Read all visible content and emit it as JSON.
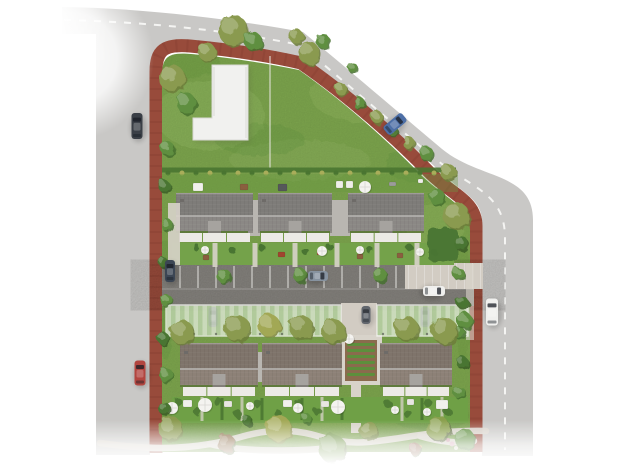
{
  "scene": {
    "description": "aerial-site-plan-render",
    "canvas": {
      "width": 640,
      "height": 470,
      "background": "#ffffff"
    },
    "palette": {
      "road": "#c9c8c6",
      "dash": "#f4f4f2",
      "curb": "#984b3b",
      "lawn": "#7ea74e",
      "lawnLight": "#93b861",
      "lawnDark": "#689840",
      "hedge": "#4a7531",
      "bushYellow": "#a9ad5a",
      "treeOlive": "#8a9a4f",
      "treeGreen": "#5f8f3f",
      "treeYellow": "#a2a855",
      "treeDark": "#3f652",
      "roofTop": "#8b8885",
      "roofTopDark": "#7e7c79",
      "ridge": "#b8b6b3",
      "roofBottom": "#8d8177",
      "roofBottomDark": "#7f746b",
      "connector": "#b9b6b1",
      "facade": "#eceae6",
      "notch": "#a6a39f",
      "path": "#d8d3ca",
      "apron": "#d2ccc3",
      "asphalt": "#87847f",
      "asphaltDark": "#7b7873",
      "parkingLine": "#e0dedb",
      "carport": "#e3ecdb",
      "carportStripe": "#c2d8b3",
      "carportFrame": "#f2f4ee",
      "soil": "#8a6b4d",
      "bed": "#5d8f3c",
      "terrace": "#f0efec",
      "chimney": "#6e6b68"
    },
    "roads": {
      "surface": "M 62,7 C 140,8 225,18 303,32 C 355,75 405,118 442,149 C 480,180 533,172 533,220 L 533,456 L 482,456 L 482,222 C 482,198 462,194 433,165 C 398,132 348,90 297,57 C 255,49 220,44 190,41 C 164,39 150,47 150,70 L 150,455 L 96,455 L 96,34 L 62,34 Z",
      "curb": "M 156,453 L 156,72 C 156,50 164,44 190,46 C 222,49 262,54 301,63 C 349,96 397,139 427,170 C 451,195 476,200 476,226 L 476,452",
      "centerDash": "M 64,20 C 150,22 232,31 300,45 C 350,86 400,130 437,160 C 470,188 505,192 505,238 L 505,450",
      "site": "M 162,452 L 162,76 C 162,57 168,52 191,54 C 224,57 260,62 299,70 C 345,102 390,143 420,174 C 444,198 470,206 470,230 L 470,452 Z"
    },
    "lawnPatches": [
      {
        "x": 210,
        "y": 115,
        "rx": 55,
        "ry": 35,
        "c": "lawnLight",
        "o": 0.45
      },
      {
        "x": 370,
        "y": 95,
        "rx": 60,
        "ry": 28,
        "c": "lawnLight",
        "o": 0.4
      },
      {
        "x": 300,
        "y": 160,
        "rx": 70,
        "ry": 20,
        "c": "lawnLight",
        "o": 0.35
      },
      {
        "x": 435,
        "y": 225,
        "rx": 30,
        "ry": 22,
        "c": "lawnLight",
        "o": 0.4
      },
      {
        "x": 190,
        "y": 60,
        "rx": 30,
        "ry": 18,
        "c": "lawnDark",
        "o": 0.35
      },
      {
        "x": 260,
        "y": 140,
        "rx": 45,
        "ry": 16,
        "c": "lawnDark",
        "o": 0.3
      },
      {
        "x": 420,
        "y": 165,
        "rx": 35,
        "ry": 18,
        "c": "lawnDark",
        "o": 0.3
      },
      {
        "x": 200,
        "y": 425,
        "rx": 55,
        "ry": 20,
        "c": "lawnDark",
        "o": 0.35
      },
      {
        "x": 300,
        "y": 430,
        "rx": 60,
        "ry": 18,
        "c": "lawnLight",
        "o": 0.4
      },
      {
        "x": 430,
        "y": 415,
        "rx": 40,
        "ry": 16,
        "c": "lawnDark",
        "o": 0.3
      },
      {
        "x": 166,
        "y": 300,
        "rx": 10,
        "ry": 60,
        "c": "lawnDark",
        "o": 0.3
      },
      {
        "x": 463,
        "y": 300,
        "rx": 9,
        "ry": 60,
        "c": "lawnDark",
        "o": 0.25
      }
    ],
    "lBuilding": {
      "outline": "M 212,65 L 248,65 L 248,140 L 193,140 L 193,118 L 212,118 Z",
      "fill": "#f1f1ef",
      "edge": "#d9d9d6",
      "fenceX": 270,
      "fenceTop": 56,
      "fenceBottom": 168
    },
    "boundaryHedge": {
      "y": 170,
      "x1": 162,
      "x2": 456,
      "dotStep": 14
    },
    "sharedGarden": {
      "x": 162,
      "y": 174,
      "w": 296,
      "h": 18
    },
    "furniture": [
      {
        "x": 193,
        "y": 183,
        "w": 10,
        "h": 8,
        "c": "#f1f0ec"
      },
      {
        "x": 240,
        "y": 184,
        "w": 8,
        "h": 6,
        "c": "#8a5f3f"
      },
      {
        "x": 278,
        "y": 184,
        "w": 9,
        "h": 7,
        "c": "#55585a"
      },
      {
        "x": 336,
        "y": 181,
        "w": 7,
        "h": 7,
        "c": "#efeeea"
      },
      {
        "x": 346,
        "y": 181,
        "w": 7,
        "h": 7,
        "c": "#efeeea"
      },
      {
        "x": 389,
        "y": 182,
        "w": 7,
        "h": 4,
        "c": "#9b9c9a"
      },
      {
        "x": 418,
        "y": 179,
        "w": 5,
        "h": 4,
        "c": "#efeeea"
      },
      {
        "x": 278,
        "y": 252,
        "w": 7,
        "h": 5,
        "c": "#a0452f"
      },
      {
        "x": 203,
        "y": 255,
        "w": 6,
        "h": 5,
        "c": "#8a5f3f"
      },
      {
        "x": 317,
        "y": 250,
        "w": 6,
        "h": 5,
        "c": "#a0452f"
      },
      {
        "x": 357,
        "y": 254,
        "w": 6,
        "h": 5,
        "c": "#8a5f3f"
      },
      {
        "x": 397,
        "y": 253,
        "w": 6,
        "h": 5,
        "c": "#8a5f3f"
      },
      {
        "x": 436,
        "y": 400,
        "w": 12,
        "h": 9,
        "c": "#f1f0ec"
      },
      {
        "x": 183,
        "y": 400,
        "w": 9,
        "h": 7,
        "c": "#f1f0ec"
      },
      {
        "x": 283,
        "y": 400,
        "w": 9,
        "h": 7,
        "c": "#f1f0ec"
      },
      {
        "x": 224,
        "y": 401,
        "w": 8,
        "h": 6,
        "c": "#e8e6e2"
      },
      {
        "x": 321,
        "y": 401,
        "w": 8,
        "h": 6,
        "c": "#e8e6e2"
      },
      {
        "x": 407,
        "y": 399,
        "w": 7,
        "h": 6,
        "c": "#e8e6e2"
      }
    ],
    "parking": {
      "asphalt": {
        "x": 162,
        "y": 264,
        "w": 312,
        "h": 42
      },
      "bayLines": {
        "from": 180,
        "to": 396,
        "step": 18,
        "y1": 266,
        "y2": 288
      },
      "apron": {
        "x": 405,
        "y": 263,
        "w": 78,
        "h": 26
      },
      "sidewalk": {
        "x": 466,
        "y": 264,
        "w": 8,
        "h": 76
      }
    },
    "carports": {
      "y": 305,
      "h": 31,
      "segments": [
        {
          "x": 166,
          "w": 175
        },
        {
          "x": 377,
          "w": 91
        }
      ],
      "corridor": {
        "x": 341,
        "y": 303,
        "w": 36,
        "h": 34
      }
    },
    "communityGarden": {
      "frame": {
        "x": 340,
        "y": 335,
        "w": 42,
        "h": 50
      },
      "soil": {
        "x": 345,
        "y": 340,
        "w": 32,
        "h": 41
      },
      "rows": {
        "x": 347,
        "w": 28,
        "y0": 343,
        "step": 6,
        "h": 3,
        "count": 6
      },
      "southPath": {
        "x": 351,
        "y": 385,
        "w": 10,
        "h": 48
      }
    },
    "houses": [
      {
        "row": "top",
        "x": 176,
        "w": 77
      },
      {
        "row": "top",
        "x": 258,
        "w": 74
      },
      {
        "row": "top",
        "x": 348,
        "w": 76
      },
      {
        "row": "bottom",
        "x": 180,
        "w": 78
      },
      {
        "row": "bottom",
        "x": 262,
        "w": 80
      },
      {
        "row": "bottom",
        "x": 380,
        "w": 72
      }
    ],
    "rowSpec": {
      "top": {
        "y": 193,
        "h": 48,
        "ridge": 216,
        "awningY": 233,
        "gardenY": 243,
        "gardenH": 22,
        "roof": "roofTop",
        "roofDark": "roofTopDark"
      },
      "bottom": {
        "y": 343,
        "h": 54,
        "ridge": 369,
        "awningY": 387,
        "gardenY": 397,
        "gardenH": 25,
        "roof": "roofBottom",
        "roofDark": "roofBottomDark"
      }
    },
    "connectors": [
      {
        "x": 248,
        "y": 200,
        "w": 12,
        "h": 36
      },
      {
        "x": 330,
        "y": 200,
        "w": 20,
        "h": 36
      },
      {
        "x": 254,
        "y": 352,
        "w": 10,
        "h": 30
      }
    ],
    "gardens": {
      "topStrip": {
        "x": 172,
        "y": 243,
        "w": 282,
        "h": 22,
        "c": "#74a24a"
      },
      "bottomStrips": [
        {
          "x": 172,
          "y": 397,
          "w": 296,
          "h": 26,
          "c": "#6fa046"
        },
        {
          "x": 380,
          "y": 397,
          "w": 86,
          "h": 26,
          "c": "#6fa046"
        }
      ],
      "topPaths": [
        215,
        255,
        295,
        337,
        377,
        417
      ],
      "westDrive": {
        "x": 168,
        "y": 203,
        "w": 12,
        "h": 62
      },
      "bottomDividersPath": [
        202,
        242,
        322,
        402,
        442
      ],
      "bottomDividersHedge": [
        222,
        262,
        302,
        342,
        422
      ]
    },
    "hedgeClumpsTop": [
      [
        196,
        247
      ],
      [
        232,
        250
      ],
      [
        262,
        248
      ],
      [
        306,
        252
      ],
      [
        330,
        247
      ],
      [
        370,
        250
      ],
      [
        410,
        248
      ],
      [
        434,
        252
      ]
    ],
    "hedgeClumpsBottom": [
      [
        178,
        402
      ],
      [
        198,
        412
      ],
      [
        218,
        402
      ],
      [
        238,
        414
      ],
      [
        258,
        404
      ],
      [
        278,
        414
      ],
      [
        298,
        403
      ],
      [
        318,
        412
      ],
      [
        388,
        404
      ],
      [
        408,
        414
      ],
      [
        428,
        403
      ],
      [
        448,
        412
      ]
    ],
    "hedgeBlock": {
      "x": 428,
      "y": 228,
      "w": 30,
      "h": 34
    },
    "flowers": [
      [
        452,
        444,
        2.5,
        "#d8a8b8"
      ],
      [
        456,
        448,
        2,
        "#e8e2d8"
      ],
      [
        448,
        440,
        2,
        "#c890a0"
      ],
      [
        420,
        447,
        2,
        "#caa24e"
      ]
    ],
    "windingPaths": [
      "M 100,443 C 150,450 180,449 210,444 C 245,438 252,430 288,431 C 318,432 330,445 368,442 C 405,439 430,430 486,431",
      "M 210,444 C 240,452 300,452 340,447",
      "M 420,436 C 440,442 460,444 474,441"
    ],
    "parasols": [
      [
        205,
        250,
        4
      ],
      [
        322,
        251,
        5
      ],
      [
        360,
        250,
        4
      ],
      [
        420,
        252,
        4
      ],
      [
        365,
        187,
        6
      ],
      [
        172,
        408,
        6
      ],
      [
        205,
        405,
        7
      ],
      [
        250,
        406,
        4
      ],
      [
        298,
        408,
        5
      ],
      [
        338,
        407,
        7
      ],
      [
        395,
        410,
        4
      ],
      [
        427,
        412,
        4
      ],
      [
        349,
        339,
        5
      ]
    ],
    "trees": [
      [
        172,
        78,
        13,
        "treeOlive"
      ],
      [
        186,
        103,
        10,
        "treeGreen"
      ],
      [
        207,
        52,
        9,
        "treeOlive"
      ],
      [
        233,
        30,
        15,
        "treeOlive"
      ],
      [
        253,
        41,
        9,
        "treeGreen"
      ],
      [
        296,
        36,
        7,
        "treeOlive"
      ],
      [
        309,
        53,
        11,
        "treeOlive"
      ],
      [
        323,
        41,
        7,
        "treeGreen"
      ],
      [
        352,
        67,
        5,
        "treeGreen"
      ],
      [
        341,
        89,
        6,
        "treeOlive"
      ],
      [
        359,
        103,
        6,
        "treeGreen"
      ],
      [
        377,
        117,
        6,
        "treeOlive"
      ],
      [
        393,
        131,
        5,
        "treeGreen"
      ],
      [
        409,
        143,
        6,
        "treeOlive"
      ],
      [
        426,
        153,
        7,
        "treeGreen"
      ],
      [
        448,
        172,
        8,
        "treeOlive"
      ],
      [
        456,
        215,
        13,
        "treeOlive"
      ],
      [
        437,
        197,
        8,
        "treeGreen"
      ],
      [
        167,
        148,
        7,
        "treeGreen"
      ],
      [
        164,
        186,
        6,
        "hedge"
      ],
      [
        167,
        225,
        6,
        "treeGreen"
      ],
      [
        163,
        262,
        5,
        "hedge"
      ],
      [
        166,
        300,
        6,
        "treeGreen"
      ],
      [
        163,
        338,
        6,
        "hedge"
      ],
      [
        166,
        375,
        7,
        "treeGreen"
      ],
      [
        164,
        408,
        6,
        "hedge"
      ],
      [
        461,
        243,
        7,
        "hedge"
      ],
      [
        458,
        273,
        6,
        "treeGreen"
      ],
      [
        462,
        302,
        6,
        "hedge"
      ],
      [
        459,
        332,
        6,
        "treeGreen"
      ],
      [
        462,
        362,
        6,
        "hedge"
      ],
      [
        459,
        392,
        6,
        "treeGreen"
      ],
      [
        182,
        332,
        12,
        "treeOlive"
      ],
      [
        237,
        328,
        13,
        "treeOlive"
      ],
      [
        269,
        325,
        11,
        "treeYellow"
      ],
      [
        301,
        327,
        12,
        "treeOlive"
      ],
      [
        333,
        331,
        12,
        "treeOlive"
      ],
      [
        406,
        328,
        12,
        "treeOlive"
      ],
      [
        444,
        330,
        13,
        "treeOlive"
      ],
      [
        464,
        320,
        8,
        "treeGreen"
      ],
      [
        224,
        276,
        7,
        "treeGreen"
      ],
      [
        300,
        275,
        7,
        "treeGreen"
      ],
      [
        380,
        275,
        7,
        "treeGreen"
      ],
      [
        170,
        428,
        12,
        "treeOlive"
      ],
      [
        226,
        443,
        9,
        "#8a6b45"
      ],
      [
        278,
        428,
        13,
        "treeYellow"
      ],
      [
        332,
        448,
        14,
        "#6f9444"
      ],
      [
        368,
        430,
        9,
        "treeOlive"
      ],
      [
        438,
        428,
        12,
        "#8aa04e"
      ],
      [
        464,
        438,
        10,
        "treeGreen"
      ],
      [
        415,
        449,
        6,
        "#8a5f45"
      ],
      [
        306,
        418,
        5,
        "treeGreen"
      ],
      [
        247,
        420,
        5,
        "hedge"
      ]
    ],
    "cars": [
      {
        "name": "car-dark-left-road",
        "c": "#3a3f46",
        "x": 137,
        "y": 126,
        "w": 11,
        "l": 26,
        "a": 0
      },
      {
        "name": "car-red-left-road",
        "c": "#b2453f",
        "x": 140,
        "y": 373,
        "w": 11,
        "l": 25,
        "a": 0
      },
      {
        "name": "car-blue-top-road",
        "c": "#4d6fa6",
        "x": 395,
        "y": 124,
        "w": 11,
        "l": 24,
        "a": 50
      },
      {
        "name": "car-white-right-road",
        "c": "#f0f0ee",
        "x": 492,
        "y": 312,
        "w": 12,
        "l": 27,
        "a": 0
      },
      {
        "name": "car-dark-parking-west",
        "c": "#3c4654",
        "x": 170,
        "y": 271,
        "w": 10,
        "l": 22,
        "a": 0
      },
      {
        "name": "car-gray-parking-bay",
        "c": "#8793a0",
        "x": 318,
        "y": 276,
        "w": 10,
        "l": 20,
        "a": 90
      },
      {
        "name": "car-white-street",
        "c": "#efefed",
        "x": 434,
        "y": 291,
        "w": 10,
        "l": 22,
        "a": 90
      }
    ],
    "carportCars": [
      {
        "name": "car-under-carport-1",
        "c": "#4a505a",
        "x": 213,
        "y": 317,
        "w": 9,
        "l": 20
      },
      {
        "name": "car-under-carport-2",
        "c": "#555b64",
        "x": 366,
        "y": 315,
        "w": 9,
        "l": 18
      },
      {
        "name": "car-under-carport-3",
        "c": "#494f59",
        "x": 425,
        "y": 317,
        "w": 9,
        "l": 20
      }
    ]
  }
}
